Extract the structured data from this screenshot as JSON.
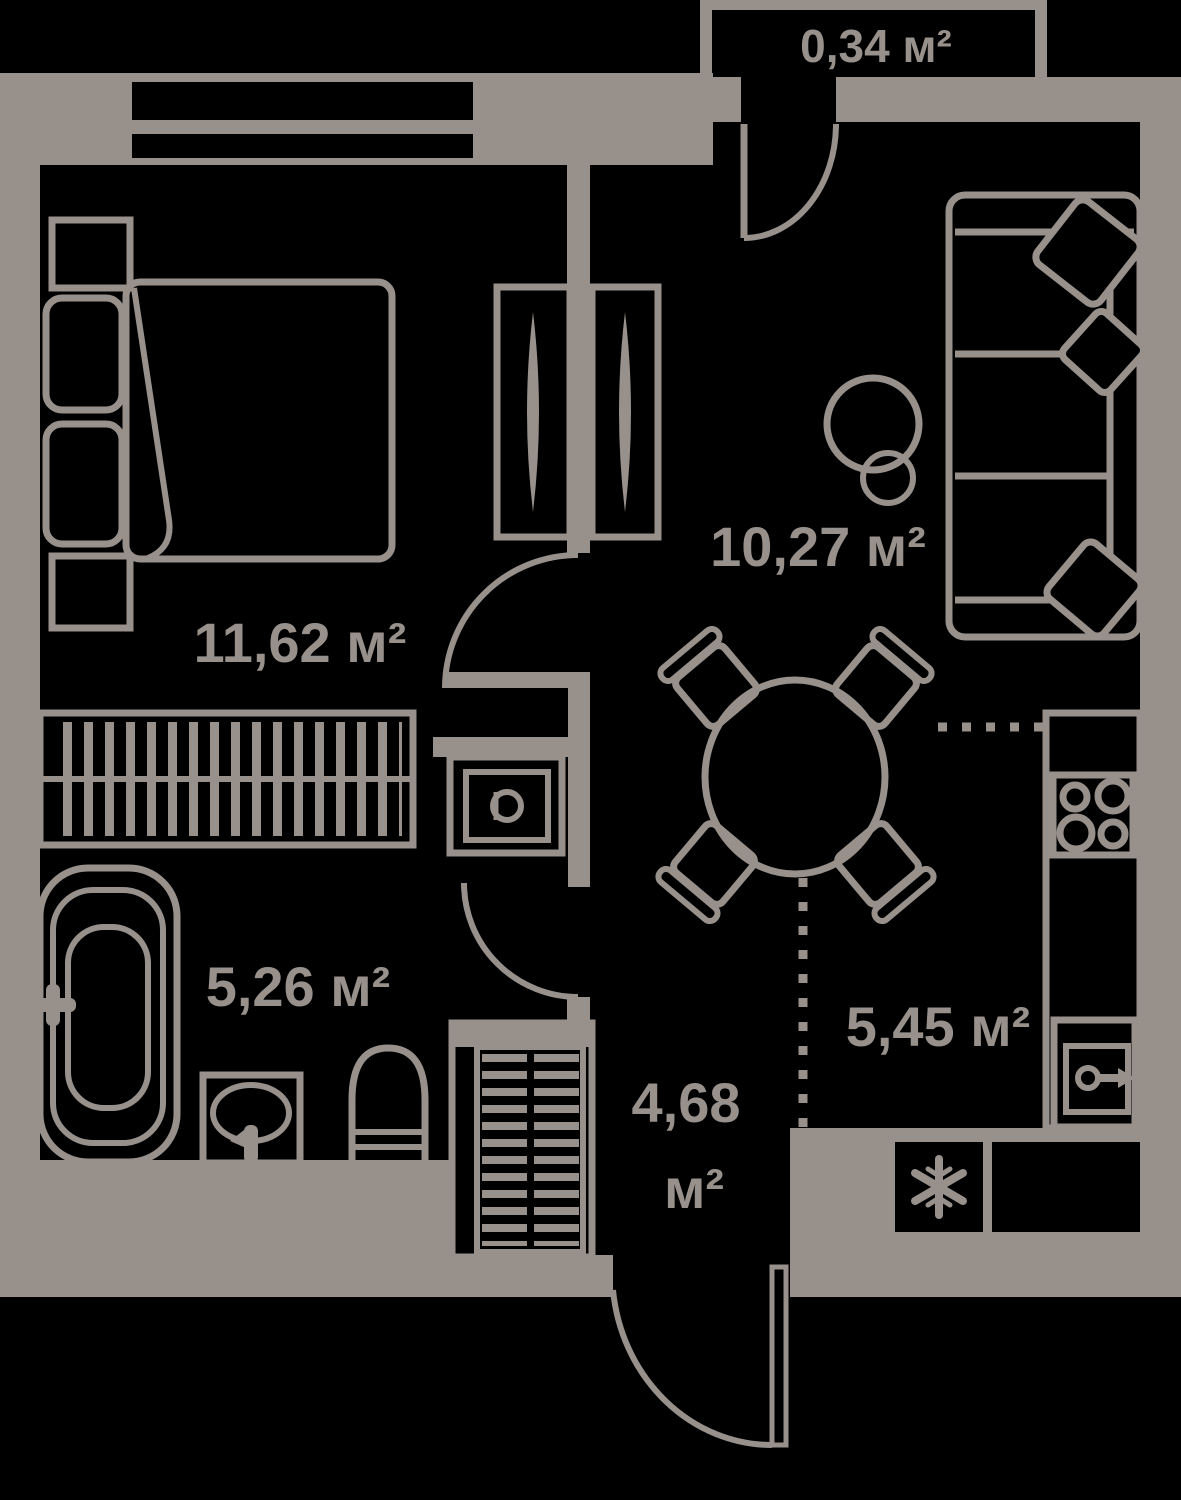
{
  "title": "apartment-floor-plan",
  "colors": {
    "wall": "#97908b",
    "background": "#000000"
  },
  "units": "м²",
  "rooms": {
    "balcony": {
      "label": "0,34 м²"
    },
    "bedroom": {
      "label": "11,62 м²"
    },
    "living_room": {
      "label": "10,27 м²"
    },
    "bathroom": {
      "label": "5,26 м²"
    },
    "kitchen": {
      "label": "5,45 м²"
    },
    "hallway": {
      "label_line1": "4,68",
      "label_line2": "м²"
    }
  },
  "icons": [
    "bed-icon",
    "pillow-icon",
    "nightstand-icon",
    "wardrobe-hangers-icon",
    "built-in-closet-icon",
    "sofa-icon",
    "sofa-cushion-icon",
    "floor-lamp-icon",
    "dining-table-icon",
    "chair-icon",
    "stove-icon",
    "kitchen-sink-icon",
    "fridge-snowflake-icon",
    "bathtub-icon",
    "faucet-icon",
    "bathroom-sink-icon",
    "toilet-icon",
    "washing-machine-icon",
    "shoe-rack-icon",
    "door-swing-icon",
    "window-icon",
    "zone-boundary-dotted-icon"
  ]
}
